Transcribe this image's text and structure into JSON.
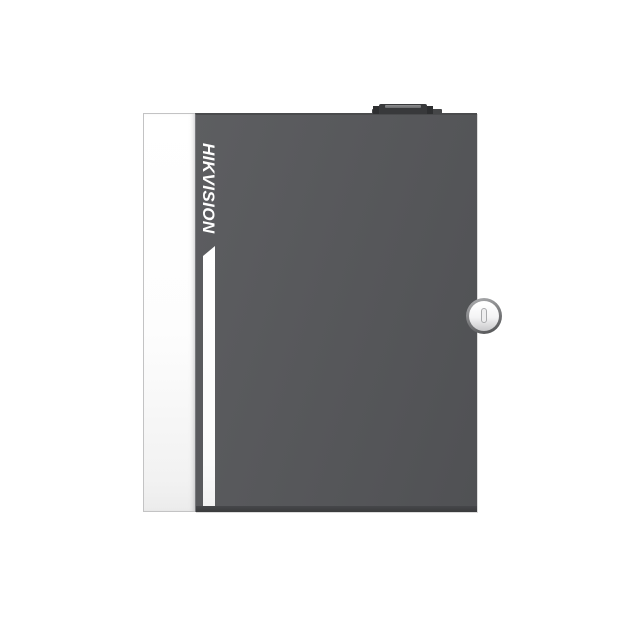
{
  "image": {
    "type": "product-photo",
    "description": "Front view of a wall-mount access controller metal enclosure on a white background",
    "background_color": "#ffffff"
  },
  "device": {
    "brand": "HIKVISION",
    "brand_text_color": "#ffffff",
    "door_color": "#56575a",
    "door_bottom_edge_color": "#3a3b3d",
    "hinge_stripe_color": "#fdfdfd",
    "hinge_stripe_border_color": "#c3c3c4",
    "accent_bar_color": "#ffffff",
    "lock": {
      "kind": "cam-lock-keyhole",
      "bezel_color": "#828385",
      "face_color": "#f3f3f4",
      "slot_outline_color": "#a9aaac"
    },
    "top_knob": {
      "kind": "tamper-knob",
      "color": "#38393b",
      "highlight_color": "#8d8e90"
    }
  }
}
